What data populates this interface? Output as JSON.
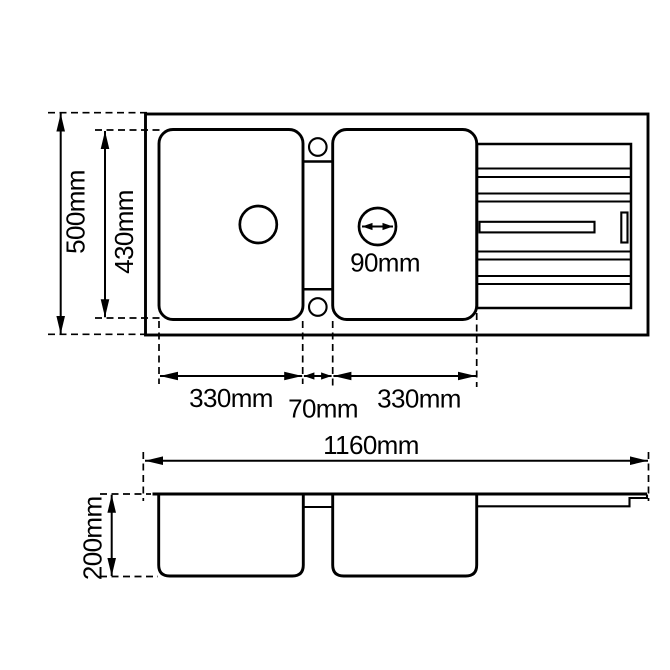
{
  "diagram": {
    "type": "technical-drawing",
    "subject": "double-bowl kitchen sink with right-hand drainer, top view and front elevation",
    "unit": "mm",
    "colors": {
      "line": "#000000",
      "background": "#ffffff"
    },
    "dimensions": {
      "overall_depth": "500mm",
      "inner_bowl_length": "430mm",
      "left_bowl_width": "330mm",
      "center_divider": "70mm",
      "right_bowl_width": "330mm",
      "drain_diameter": "90mm",
      "overall_length": "1160mm",
      "bowl_depth": "200mm"
    }
  }
}
